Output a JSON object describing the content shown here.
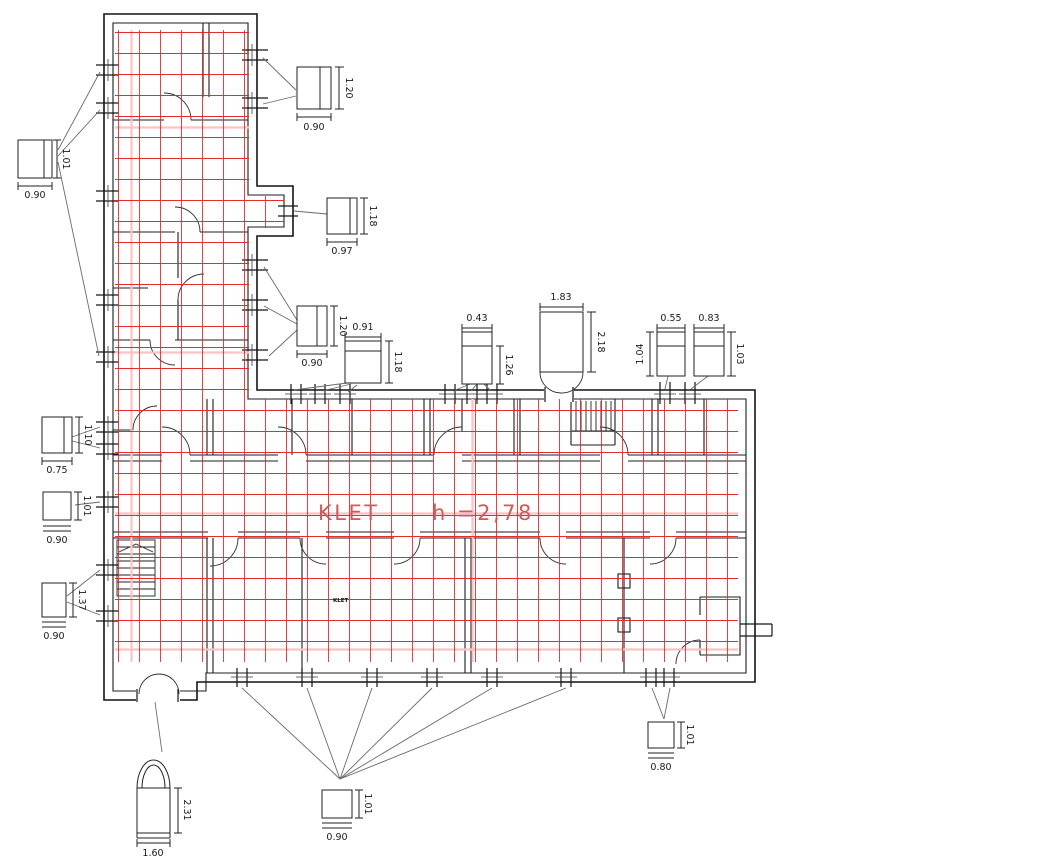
{
  "drawing": {
    "room_name": "KLET",
    "room_height": "h =2,78",
    "mini_room_label": "KLET",
    "colors": {
      "grid": "#e32222",
      "grid_light": "#ffc2c2",
      "wall": "#1c1c1c",
      "leader": "#6a6a6a",
      "dimension_text": "#1a1a1a",
      "room_text": "#d45858",
      "background": "#ffffff"
    },
    "callouts": [
      {
        "name": "window-detail-top",
        "width_m": "0.90",
        "height_m": "1.20"
      },
      {
        "name": "window-detail-left-upper",
        "width_m": "0.90",
        "height_m": "1.01"
      },
      {
        "name": "window-detail-097",
        "width_m": "0.97",
        "height_m": "1.18"
      },
      {
        "name": "window-detail-mid-120",
        "width_m": "0.90",
        "height_m": "1.20"
      },
      {
        "name": "window-detail-091",
        "width_m": "0.91",
        "height_m": "1.18"
      },
      {
        "name": "window-detail-043",
        "width_m": "0.43",
        "height_m": "1.26"
      },
      {
        "name": "entrance-door-detail",
        "width_m": "1.83",
        "height_m": "2.18"
      },
      {
        "name": "window-detail-055",
        "width_m": "0.55",
        "height_m": "1.04"
      },
      {
        "name": "window-detail-083",
        "width_m": "0.83",
        "height_m": "1.03"
      },
      {
        "name": "window-detail-075",
        "width_m": "0.75",
        "height_m": "1.10"
      },
      {
        "name": "window-detail-left-mid",
        "width_m": "0.90",
        "height_m": "1.01"
      },
      {
        "name": "window-detail-137",
        "width_m": "0.90",
        "height_m": "1.37"
      },
      {
        "name": "window-detail-bottom",
        "width_m": "0.90",
        "height_m": "1.01"
      },
      {
        "name": "window-detail-bottom-right",
        "width_m": "0.80",
        "height_m": "1.01"
      },
      {
        "name": "arched-door-detail",
        "width_m": "1.60",
        "height_m": "2.31"
      }
    ]
  }
}
